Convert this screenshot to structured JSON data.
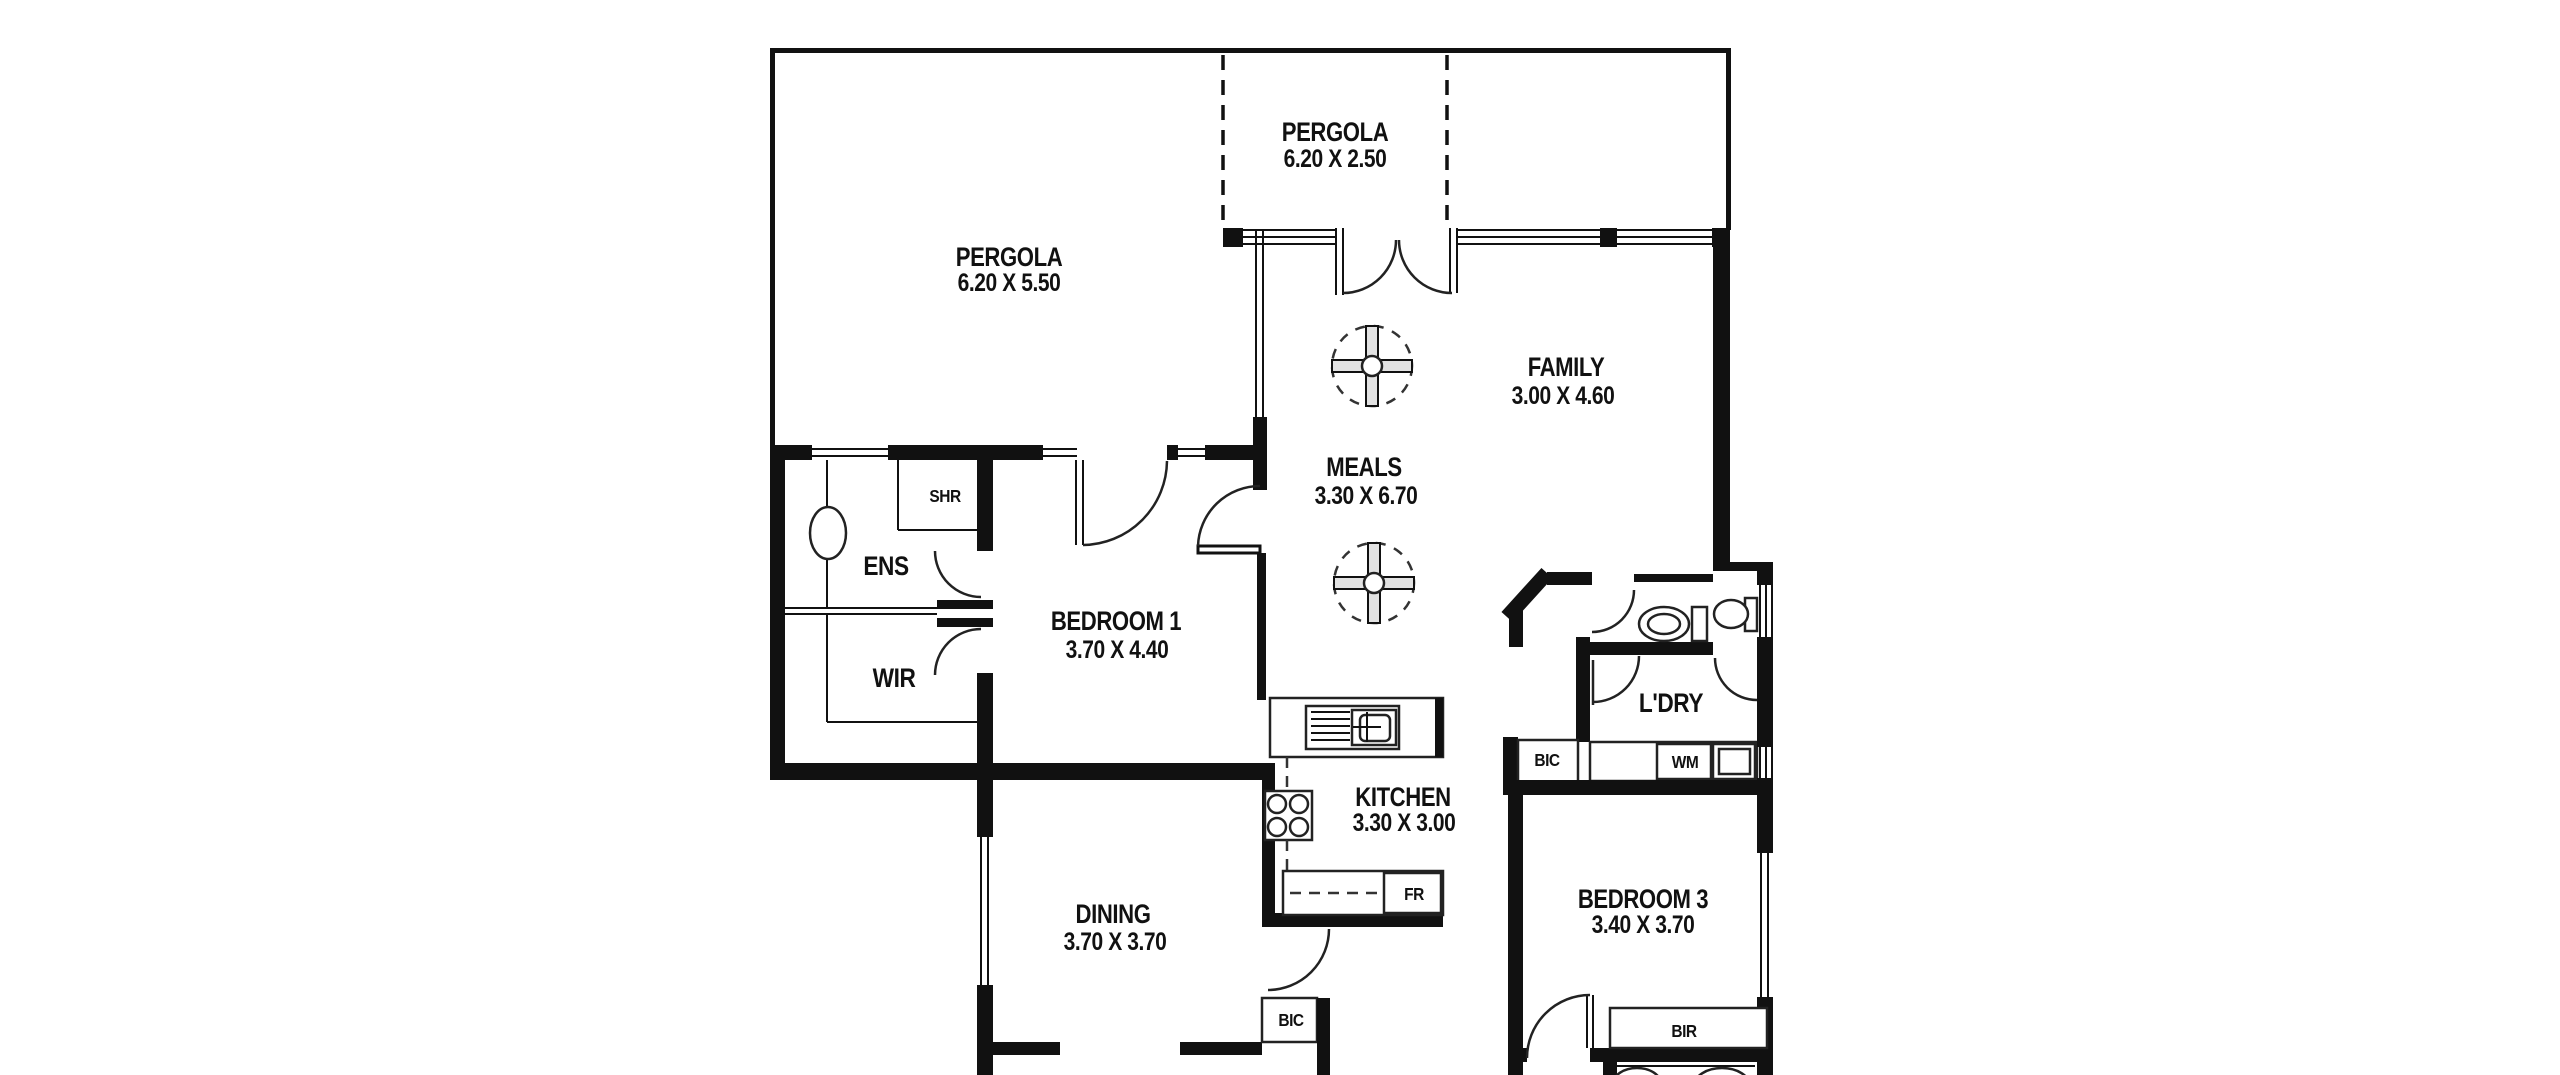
{
  "document": {
    "type": "floor-plan"
  },
  "colors": {
    "background": "#ffffff",
    "wall": "#111111",
    "line": "#222222"
  },
  "rooms": [
    {
      "name": "PERGOLA",
      "dims": "6.20 X 5.50"
    },
    {
      "name": "PERGOLA",
      "dims": "6.20 X 2.50"
    },
    {
      "name": "FAMILY",
      "dims": "3.00 X 4.60"
    },
    {
      "name": "MEALS",
      "dims": "3.30 X 6.70"
    },
    {
      "name": "BEDROOM 1",
      "dims": "3.70 X 4.40"
    },
    {
      "name": "KITCHEN",
      "dims": "3.30 X 3.00"
    },
    {
      "name": "DINING",
      "dims": "3.70 X 3.70"
    },
    {
      "name": "BEDROOM 3",
      "dims": "3.40 X 3.70"
    },
    {
      "name": "ENS"
    },
    {
      "name": "WIR"
    },
    {
      "name": "SHR"
    },
    {
      "name": "L'DRY"
    }
  ],
  "closets": {
    "bic_hall": "BIC",
    "bic_rear": "BIC",
    "wm": "WM",
    "fr": "FR",
    "bir": "BIR"
  }
}
